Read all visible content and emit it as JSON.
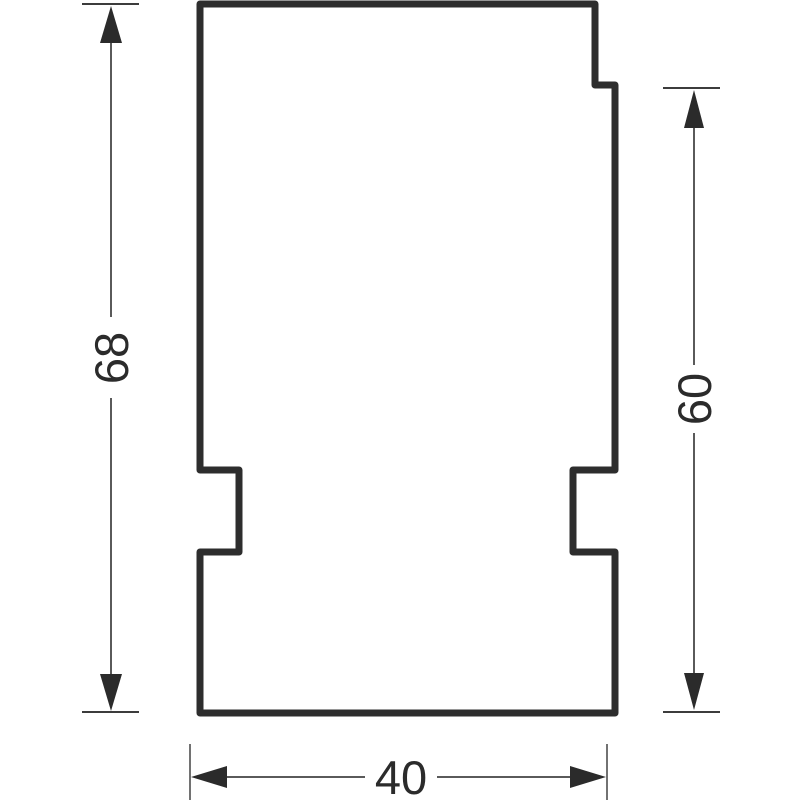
{
  "drawing": {
    "type": "technical-dimension-drawing",
    "background_color": "#ffffff",
    "outline_color": "#2d2d2d",
    "dimension_line_color": "#5a5a5a",
    "tick_color": "#3c3c3c",
    "arrow_color": "#2b2b2b",
    "text_color": "#2b2b2b",
    "part": {
      "description": "stepped plate profile with top-right step and rectangular notches on left and right edges",
      "fill": "#ffffff"
    },
    "dimensions": {
      "total_height": {
        "value": "68",
        "orientation": "vertical",
        "side": "left"
      },
      "step_height": {
        "value": "60",
        "orientation": "vertical",
        "side": "right"
      },
      "width": {
        "value": "40",
        "orientation": "horizontal",
        "side": "bottom"
      }
    }
  }
}
